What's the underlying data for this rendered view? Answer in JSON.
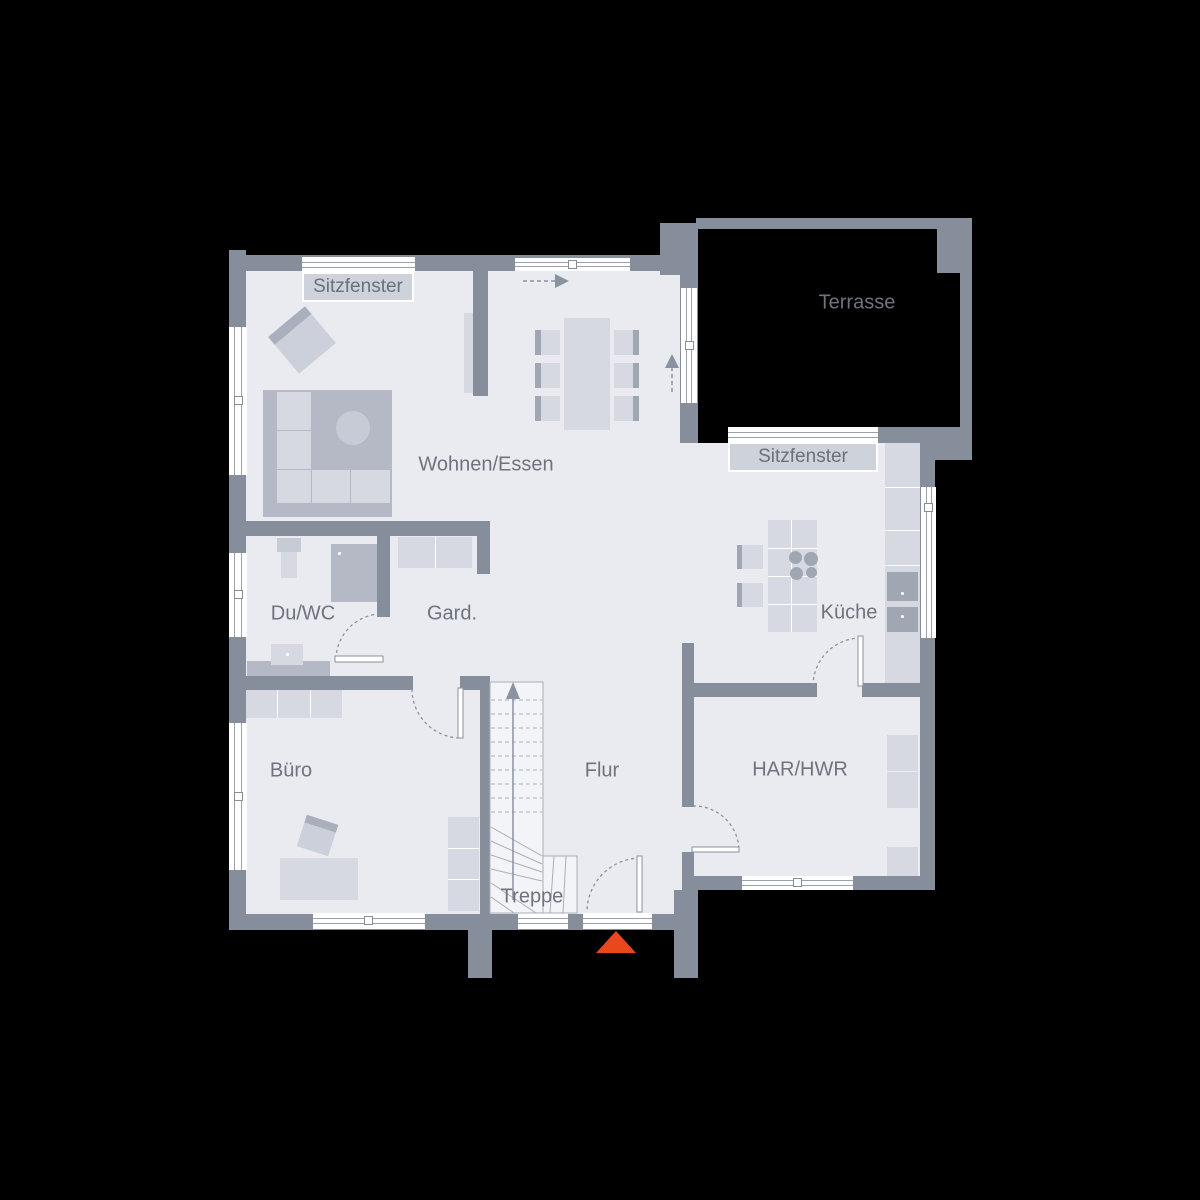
{
  "floorplan": {
    "labels": {
      "sitzfenster_top": "Sitzfenster",
      "terrasse": "Terrasse",
      "wohnen_essen": "Wohnen/Essen",
      "sitzfenster_kueche": "Sitzfenster",
      "du_wc": "Du/WC",
      "gard": "Gard.",
      "kueche": "Küche",
      "buero": "Büro",
      "flur": "Flur",
      "har_hwr": "HAR/HWR",
      "treppe": "Treppe"
    },
    "colors": {
      "background": "#000000",
      "wall": "#878e9b",
      "floor": "#e9ebf1",
      "furniture_light": "#d6d9e2",
      "furniture_dark": "#b4b9c5",
      "window": "#ffffff",
      "label_text": "#6e737e",
      "label_box_fill": "#ced2db",
      "entrance_marker": "#e8481c",
      "stair_arrow": "#8b92a0"
    }
  }
}
